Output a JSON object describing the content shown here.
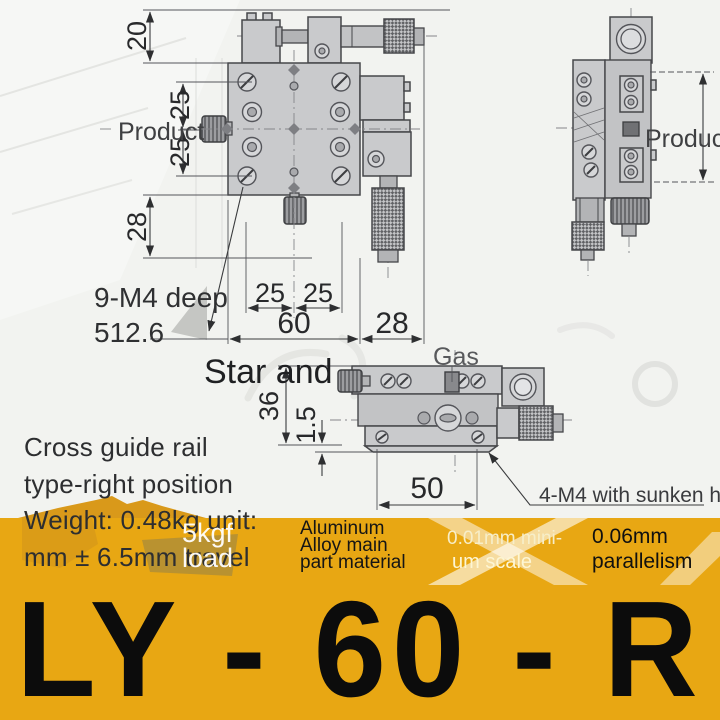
{
  "drawing": {
    "labels": {
      "product_left": "Product",
      "product_right": "Product",
      "nine_m4_line1": "9-M4 deep",
      "nine_m4_line2": "512.6",
      "star_and": "Star and",
      "gas": "Gas",
      "four_m4": "4-M4 with sunken head_"
    },
    "dims": {
      "top_offset": "20",
      "left_upper": "25",
      "left_lower": "25",
      "left_bottom": "28",
      "bottom_left": "25",
      "bottom_right": "25",
      "body_width": "60",
      "right_offset": "28",
      "side_height": "36",
      "base_lip": "1.5",
      "base_width": "50"
    }
  },
  "description": {
    "line1": "Cross guide rail",
    "line2": "type-right position",
    "line3": "Weight: 0.48kg unit:",
    "line4": "mm ± 6.5mm travel"
  },
  "load_badge": {
    "line1": "5kgf",
    "line2": "load"
  },
  "specs": [
    {
      "lines": [
        "Aluminum",
        "Alloy main",
        "part material"
      ]
    },
    {
      "lines": [
        "0.01mm mini-",
        "um scale"
      ]
    },
    {
      "lines": [
        "0.06mm",
        "parallelism"
      ]
    }
  ],
  "model": "LY - 60 - R",
  "colors": {
    "band": "#e8a713",
    "band_dark": "#d9991a",
    "model_text": "#0c0c0c"
  }
}
